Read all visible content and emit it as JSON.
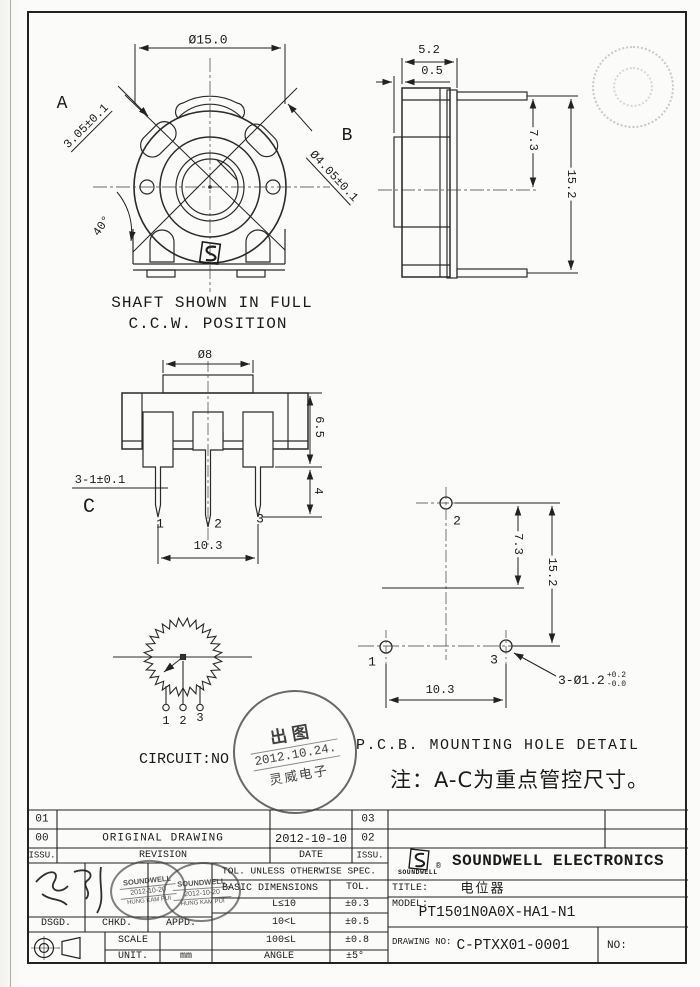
{
  "drawing": {
    "front_view": {
      "dim_outer_dia": "Ø15.0",
      "label_a": "A",
      "dim_a": "3.05±0.1",
      "label_b": "B",
      "dim_b": "Ø4.05±0.1",
      "dim_angle": "40°",
      "caption1": "SHAFT SHOWN IN FULL",
      "caption2": "C.C.W. POSITION"
    },
    "side_view": {
      "dim_depth": "5.2",
      "dim_step": "0.5",
      "dim_upper": "7.3",
      "dim_height": "15.2"
    },
    "pin_view": {
      "dim_shaft_dia": "Ø8",
      "dim_body": "6.5",
      "dim_pin": "4",
      "dim_pin_note": "3-1±0.1",
      "label_c": "C",
      "pin1": "1",
      "pin2": "2",
      "pin3": "3",
      "dim_pitch": "10.3"
    },
    "pcb_view": {
      "caption": "P.C.B. MOUNTING HOLE DETAIL",
      "dim_upper": "7.3",
      "dim_height": "15.2",
      "dim_pitch": "10.3",
      "hole1": "1",
      "hole2": "2",
      "hole3": "3",
      "dim_holes": "3-Ø1.2",
      "tol_plus": "+0.2",
      "tol_minus": "-0.0"
    },
    "circuit": {
      "caption": "CIRCUIT:NO",
      "pin1": "1",
      "pin2": "2",
      "pin3": "3"
    },
    "note": "注：A-C为重点管控尺寸。"
  },
  "release_stamp": {
    "top": "出图",
    "date": "2012.10.24.",
    "bottom": "灵威电子"
  },
  "title_block": {
    "revisions": [
      {
        "issue": "01",
        "description": "",
        "date": "",
        "issue2": "03"
      },
      {
        "issue": "00",
        "description": "ORIGINAL DRAWING",
        "date": "2012-10-10",
        "issue2": "02"
      }
    ],
    "headers": {
      "issue": "ISSU.",
      "revision": "REVISION",
      "date": "DATE",
      "issue2": "ISSU."
    },
    "approval": {
      "dsgd": "DSGD.",
      "chkd": "CHKD.",
      "appd": "APPD.",
      "stamp_company": "SOUNDWELL",
      "stamp_date": "2012-10-20",
      "stamp_name": "HUNG KAM PUI"
    },
    "tolerance": {
      "header": "TOL. UNLESS OTHERWISE SPEC.",
      "col1": "BASIC DIMENSIONS",
      "col2": "TOL.",
      "rows": [
        {
          "dim": "L≤10",
          "tol": "±0.3"
        },
        {
          "dim": "10<L",
          "tol": "±0.5"
        },
        {
          "dim": "100≤L",
          "tol": "±0.8"
        },
        {
          "dim": "ANGLE",
          "tol": "±5°"
        }
      ]
    },
    "scale_label": "SCALE",
    "unit_label": "UNIT.",
    "unit_value": "mm",
    "company": {
      "logo_text": "SOUNDWELL",
      "reg": "®",
      "name": "SOUNDWELL ELECTRONICS"
    },
    "title_label": "TITLE:",
    "title_value": "电位器",
    "model_label": "MODEL:",
    "model_value": "PT1501N0A0X-HA1-N1",
    "drawing_no_label": "DRAWING NO:",
    "drawing_no_value": "C-PTXX01-0001",
    "no_label": "NO:"
  }
}
